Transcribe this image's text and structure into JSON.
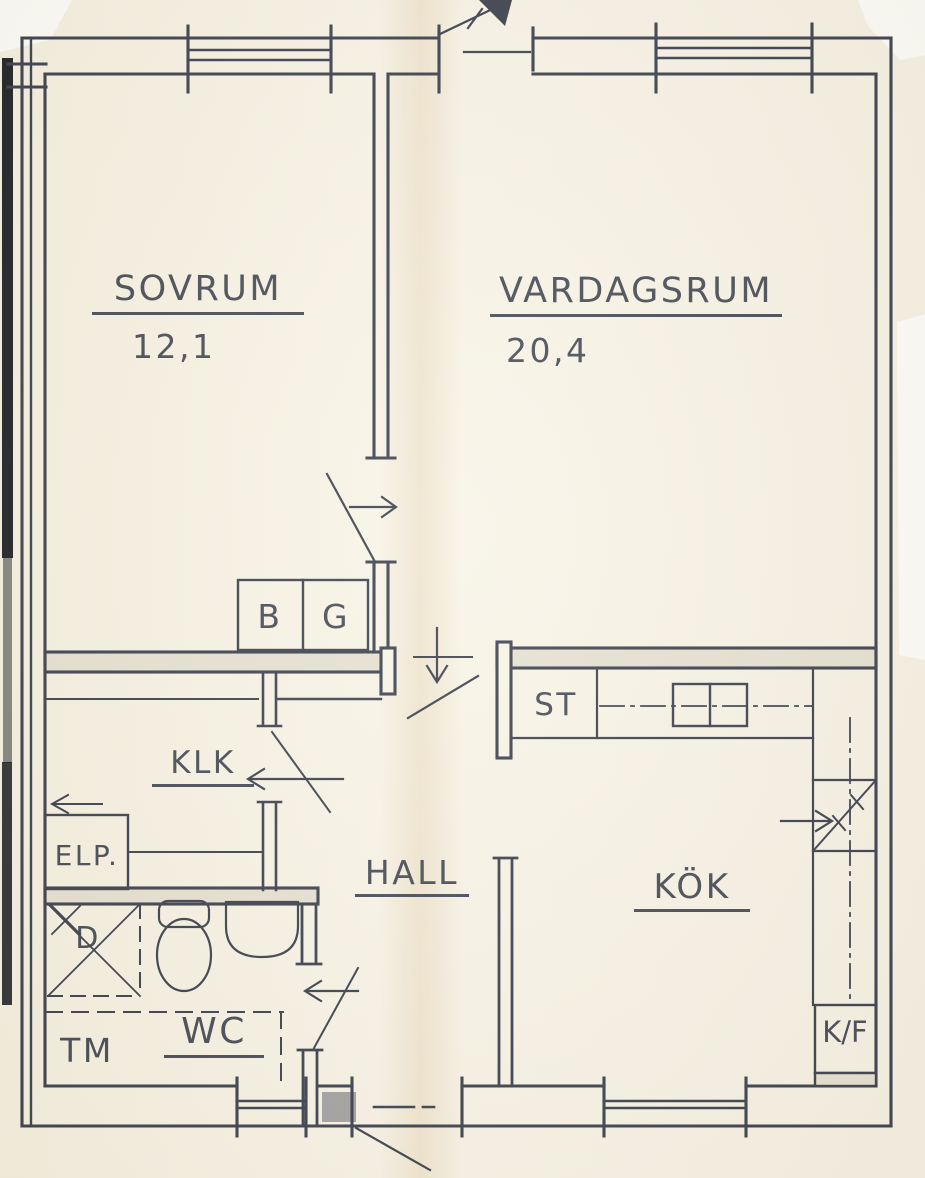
{
  "document": {
    "kind": "scanned apartment floor plan",
    "language": "Swedish"
  },
  "colors": {
    "ink": "#3d4350",
    "paper": "#f8f4e7",
    "wall_fill": "#e6e1d1",
    "scan_bar": "#16191f"
  },
  "rooms": {
    "sovrum": {
      "label": "SOVRUM",
      "area": "12,1"
    },
    "vardagsrum": {
      "label": "VARDAGSRUM",
      "area": "20,4"
    },
    "klk": {
      "label": "KLK"
    },
    "hall": {
      "label": "HALL"
    },
    "kok": {
      "label": "KÖK"
    },
    "wc": {
      "label": "WC"
    }
  },
  "fixtures": {
    "closet_b": "B",
    "closet_g": "G",
    "elp": "ELP.",
    "st": "ST",
    "shower": "D",
    "washing_machine": "TM",
    "fridge_freezer": "K/F"
  }
}
